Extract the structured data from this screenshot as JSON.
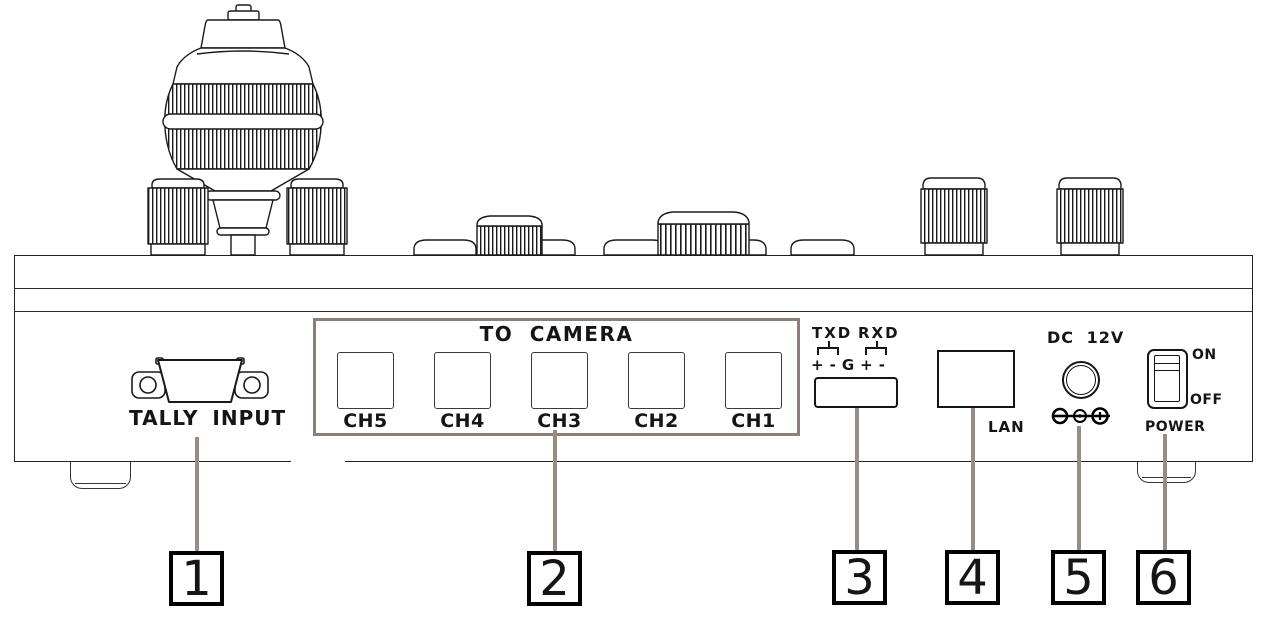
{
  "panel": {
    "tally": {
      "label": "TALLY INPUT"
    },
    "camera": {
      "title": "TO CAMERA",
      "channels": [
        "CH5",
        "CH4",
        "CH3",
        "CH2",
        "CH1"
      ]
    },
    "serial": {
      "txd_label": "TXD",
      "rxd_label": "RXD",
      "pins": [
        "+",
        "-",
        "G",
        "+",
        "-"
      ]
    },
    "lan": {
      "label": "LAN"
    },
    "power_jack": {
      "label": "DC 12V",
      "polarity_icon": "dc-polarity-center-positive"
    },
    "power_switch": {
      "on_label": "ON",
      "off_label": "OFF",
      "label": "POWER"
    }
  },
  "callouts": [
    "1",
    "2",
    "3",
    "4",
    "5",
    "6"
  ],
  "colors": {
    "callout_line": "#9a8c83",
    "camera_box_border": "#8c7f76",
    "ink": "#151515"
  }
}
